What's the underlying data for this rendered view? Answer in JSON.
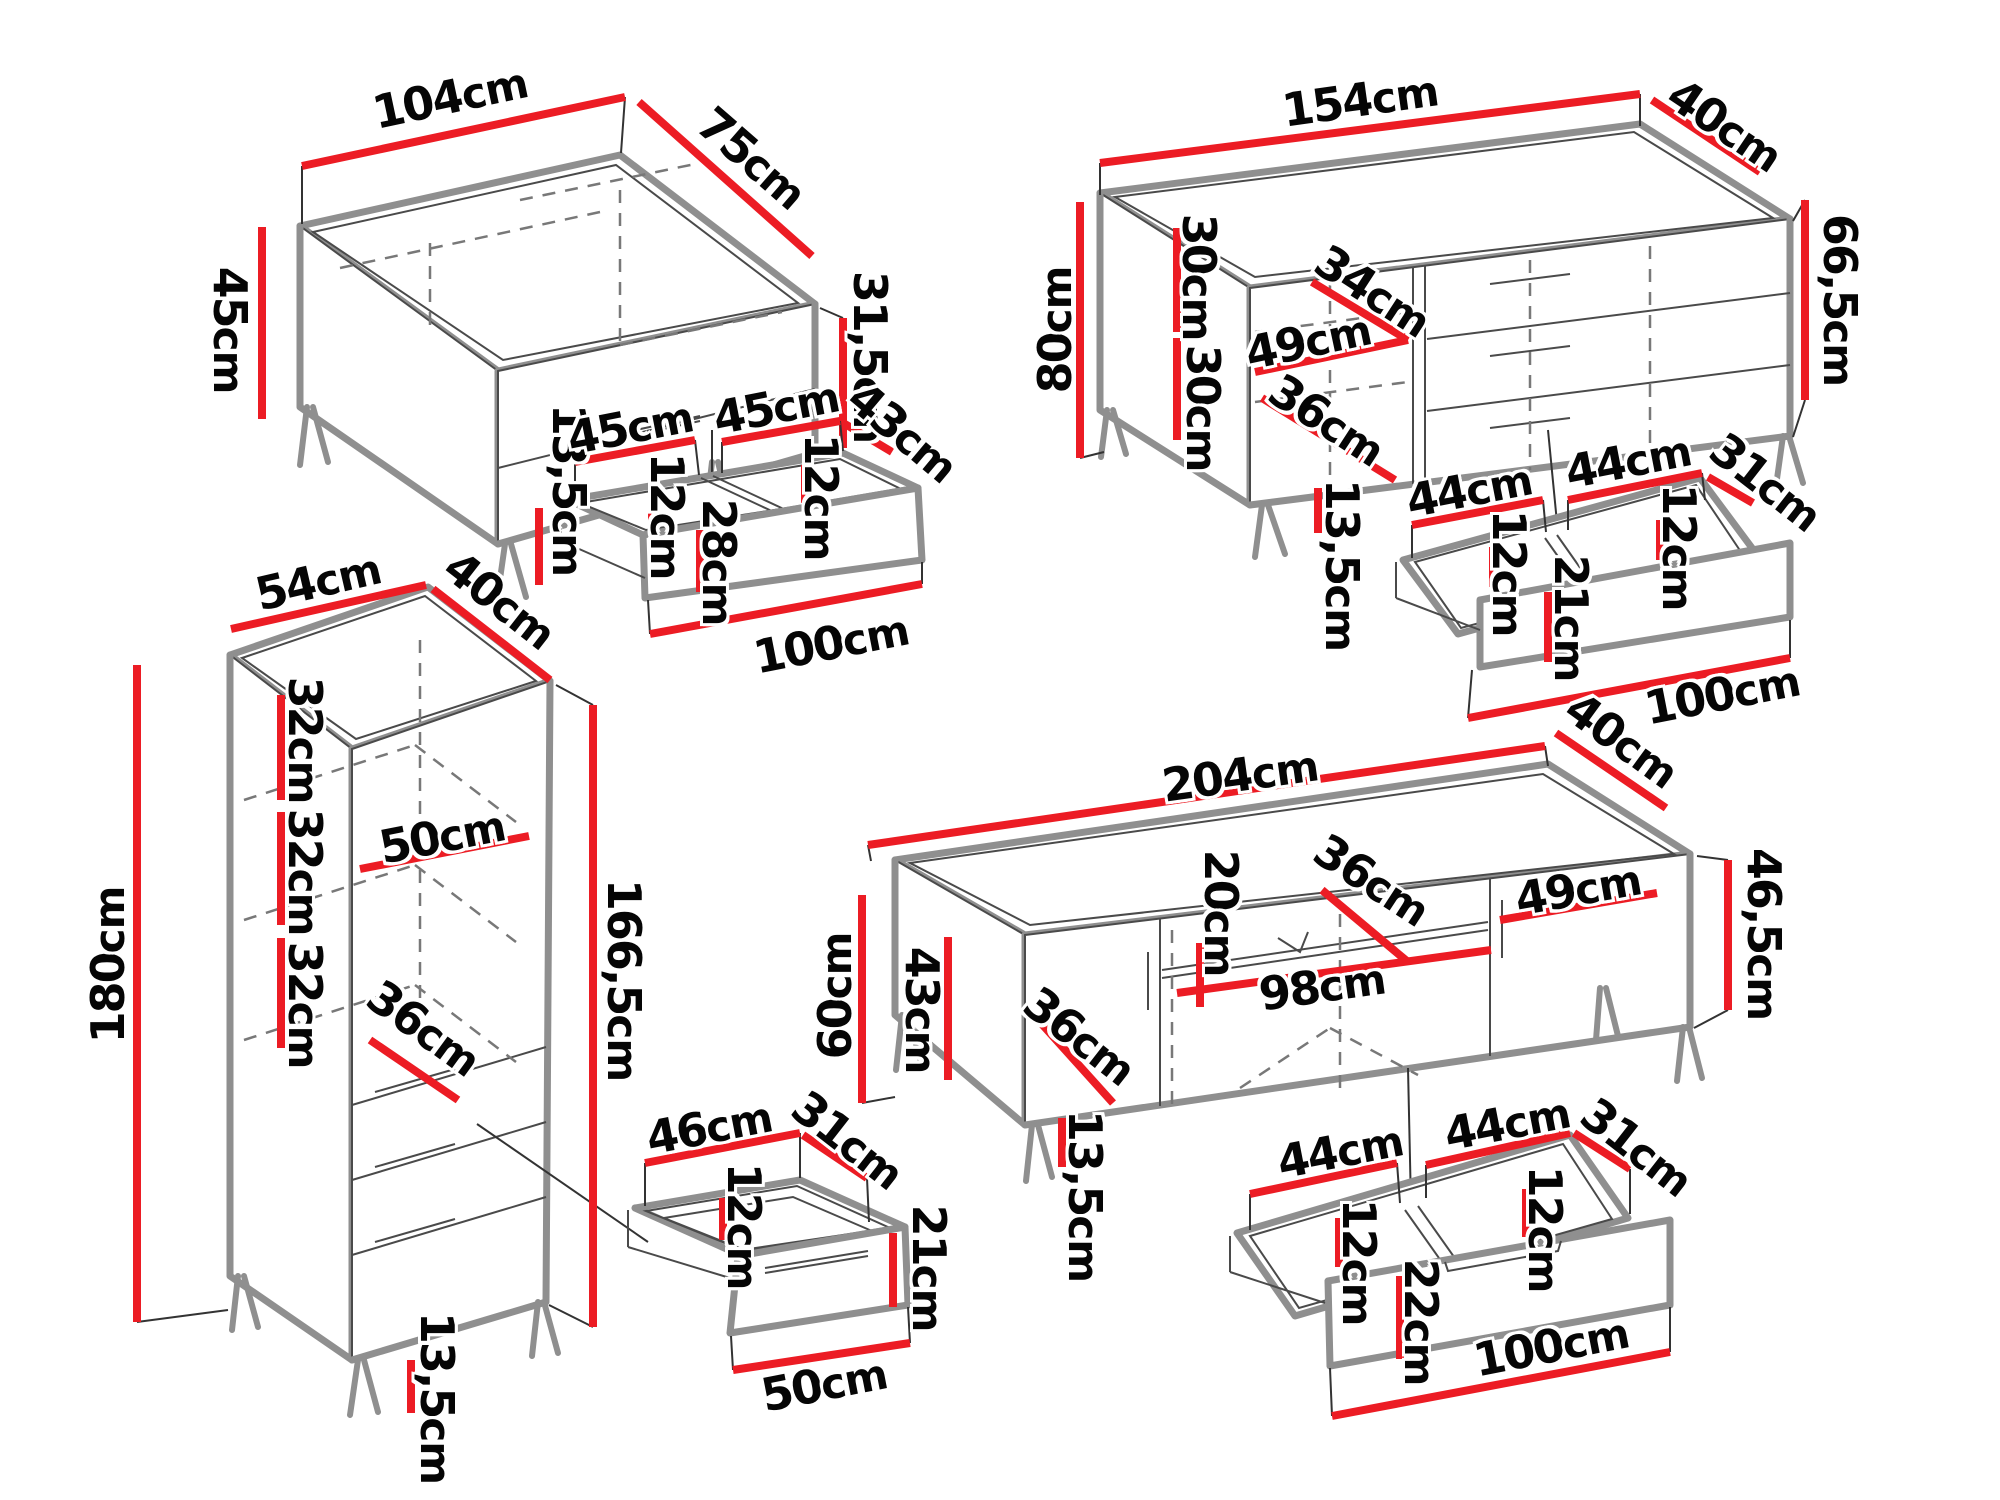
{
  "diagram": "furniture-dimensions",
  "unit": "cm",
  "colors": {
    "dimension_red": "#ec1c24",
    "outline_gray": "#8f8f8f",
    "text": "#050505"
  },
  "pieces": [
    {
      "id": "coffee-table",
      "labels": [
        {
          "value": "104",
          "unit": "cm"
        },
        {
          "value": "75",
          "unit": "cm"
        },
        {
          "value": "45",
          "unit": "cm"
        },
        {
          "value": "31,5",
          "unit": "cm"
        },
        {
          "value": "13,5",
          "unit": "cm"
        }
      ]
    },
    {
      "id": "coffee-table-drawer",
      "labels": [
        {
          "value": "45",
          "unit": "cm"
        },
        {
          "value": "45",
          "unit": "cm"
        },
        {
          "value": "43",
          "unit": "cm"
        },
        {
          "value": "12",
          "unit": "cm"
        },
        {
          "value": "12",
          "unit": "cm"
        },
        {
          "value": "28",
          "unit": "cm"
        },
        {
          "value": "100",
          "unit": "cm"
        }
      ]
    },
    {
      "id": "sideboard",
      "labels": [
        {
          "value": "154",
          "unit": "cm"
        },
        {
          "value": "40",
          "unit": "cm"
        },
        {
          "value": "80",
          "unit": "cm"
        },
        {
          "value": "30",
          "unit": "cm"
        },
        {
          "value": "30",
          "unit": "cm"
        },
        {
          "value": "34",
          "unit": "cm"
        },
        {
          "value": "49",
          "unit": "cm"
        },
        {
          "value": "36",
          "unit": "cm"
        },
        {
          "value": "66,5",
          "unit": "cm"
        },
        {
          "value": "13,5",
          "unit": "cm"
        }
      ]
    },
    {
      "id": "sideboard-drawer",
      "labels": [
        {
          "value": "44",
          "unit": "cm"
        },
        {
          "value": "44",
          "unit": "cm"
        },
        {
          "value": "31",
          "unit": "cm"
        },
        {
          "value": "12",
          "unit": "cm"
        },
        {
          "value": "12",
          "unit": "cm"
        },
        {
          "value": "21",
          "unit": "cm"
        },
        {
          "value": "100",
          "unit": "cm"
        }
      ]
    },
    {
      "id": "tall-cabinet",
      "labels": [
        {
          "value": "54",
          "unit": "cm"
        },
        {
          "value": "40",
          "unit": "cm"
        },
        {
          "value": "180",
          "unit": "cm"
        },
        {
          "value": "32",
          "unit": "cm"
        },
        {
          "value": "32",
          "unit": "cm"
        },
        {
          "value": "32",
          "unit": "cm"
        },
        {
          "value": "50",
          "unit": "cm"
        },
        {
          "value": "36",
          "unit": "cm"
        },
        {
          "value": "166,5",
          "unit": "cm"
        },
        {
          "value": "13,5",
          "unit": "cm"
        }
      ]
    },
    {
      "id": "cabinet-drawer",
      "labels": [
        {
          "value": "46",
          "unit": "cm"
        },
        {
          "value": "31",
          "unit": "cm"
        },
        {
          "value": "12",
          "unit": "cm"
        },
        {
          "value": "21",
          "unit": "cm"
        },
        {
          "value": "50",
          "unit": "cm"
        }
      ]
    },
    {
      "id": "tv-stand",
      "labels": [
        {
          "value": "204",
          "unit": "cm"
        },
        {
          "value": "40",
          "unit": "cm"
        },
        {
          "value": "60",
          "unit": "cm"
        },
        {
          "value": "43",
          "unit": "cm"
        },
        {
          "value": "20",
          "unit": "cm"
        },
        {
          "value": "36",
          "unit": "cm"
        },
        {
          "value": "49",
          "unit": "cm"
        },
        {
          "value": "98",
          "unit": "cm"
        },
        {
          "value": "36",
          "unit": "cm"
        },
        {
          "value": "46,5",
          "unit": "cm"
        },
        {
          "value": "13,5",
          "unit": "cm"
        }
      ]
    },
    {
      "id": "tv-stand-drawer",
      "labels": [
        {
          "value": "44",
          "unit": "cm"
        },
        {
          "value": "44",
          "unit": "cm"
        },
        {
          "value": "31",
          "unit": "cm"
        },
        {
          "value": "12",
          "unit": "cm"
        },
        {
          "value": "12",
          "unit": "cm"
        },
        {
          "value": "22",
          "unit": "cm"
        },
        {
          "value": "100",
          "unit": "cm"
        }
      ]
    }
  ]
}
